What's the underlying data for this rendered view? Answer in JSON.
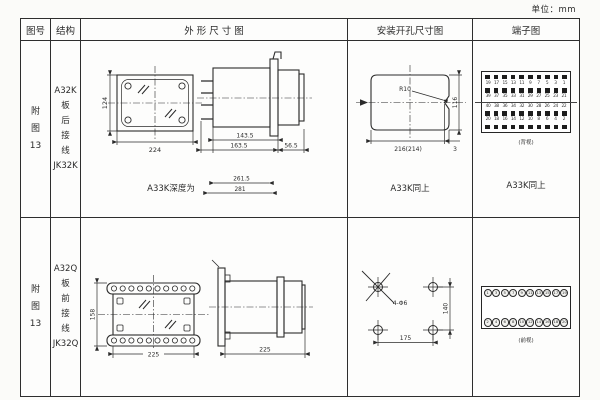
{
  "unit_label": "单位：mm",
  "header": {
    "fig": "图号",
    "structure": "结构",
    "outline": "外 形 尺 寸 图",
    "mounting": "安装开孔尺寸图",
    "terminal": "端子图"
  },
  "row1": {
    "fig_no": [
      "附",
      "图",
      "13"
    ],
    "structure": [
      "A32K",
      "板",
      "后",
      "接",
      "线",
      "JK32K"
    ],
    "outline": {
      "front_height": "124",
      "front_width": "224",
      "side_len_inner": "143.5",
      "side_len_outer": "163.5",
      "side_depth": "56.5",
      "depth_note": "A33K深度为",
      "depth_inner": "261.5",
      "depth_outer": "281"
    },
    "mounting": {
      "corner_radius": "R10",
      "cut_width": "216(214)",
      "cut_height": "116",
      "edge_gap": "3",
      "note": "A33K同上"
    },
    "terminal": {
      "number_rows": [
        [
          "19",
          "17",
          "15",
          "13",
          "11",
          "9",
          "7",
          "5",
          "3",
          "1"
        ],
        [
          "39",
          "37",
          "35",
          "33",
          "31",
          "29",
          "27",
          "25",
          "23",
          "21"
        ],
        [
          "40",
          "38",
          "36",
          "34",
          "32",
          "30",
          "28",
          "26",
          "24",
          "22"
        ],
        [
          "20",
          "18",
          "16",
          "14",
          "12",
          "10",
          "8",
          "6",
          "4",
          "2"
        ]
      ],
      "caption": "(背视)",
      "note": "A33K同上"
    }
  },
  "row2": {
    "fig_no": [
      "附",
      "图",
      "13"
    ],
    "structure": [
      "A32Q",
      "板",
      "前",
      "接",
      "线",
      "JK32Q"
    ],
    "outline": {
      "front_height": "158",
      "front_width": "225",
      "side_width": "225"
    },
    "mounting": {
      "holes": "4-Φ6",
      "pitch_v": "140",
      "pitch_h": "175"
    },
    "terminal": {
      "top_row": [
        "1",
        "3",
        "5",
        "7",
        "9",
        "11",
        "13",
        "15",
        "17",
        "19"
      ],
      "bottom_row": [
        "2",
        "4",
        "6",
        "8",
        "10",
        "12",
        "14",
        "16",
        "18",
        "20"
      ],
      "caption": "(前视)"
    }
  }
}
